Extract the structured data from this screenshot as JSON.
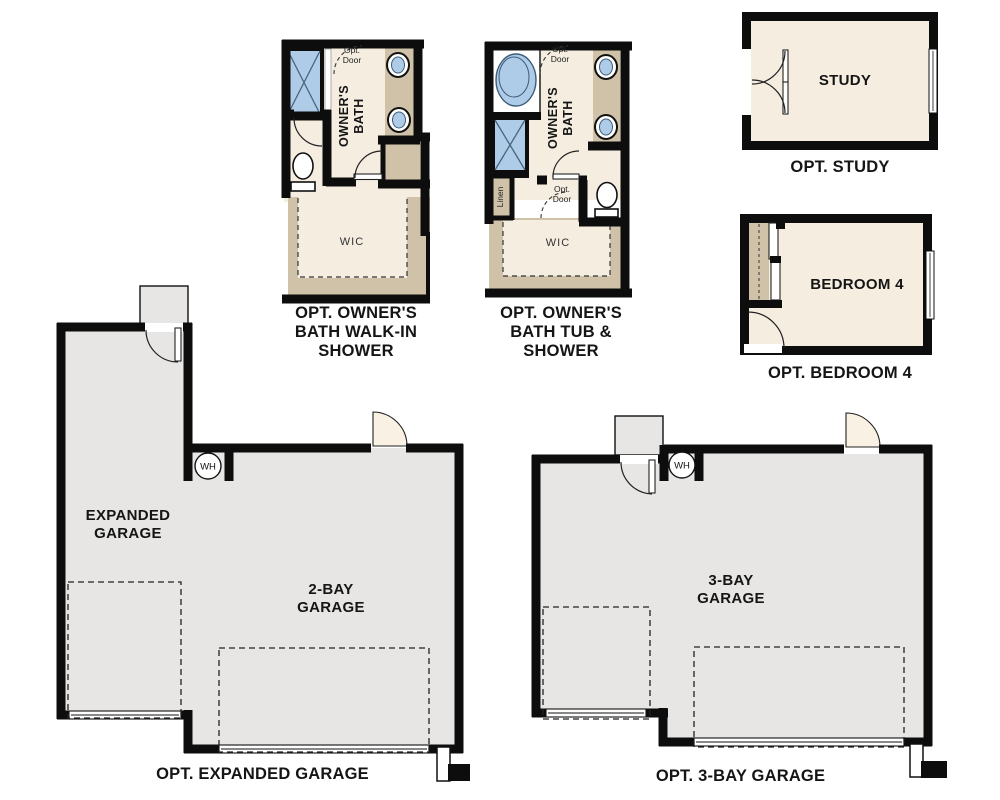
{
  "colors": {
    "wall": "#0d0d0d",
    "floor_cream": "#f5eee0",
    "floor_gray": "#e7e6e4",
    "counter_tan": "#cfc2a8",
    "fixture_blue": "#aecbe8",
    "fixture_blue_line": "#3d5c77",
    "door_cream": "#f9f1e4"
  },
  "plans": {
    "bath_walkin": {
      "caption": "OPT. OWNER'S BATH WALK-IN SHOWER",
      "room_label": "OWNER'S BATH",
      "closet_label": "WIC",
      "opt_door": "Opt. Door"
    },
    "bath_tub": {
      "caption": "OPT. OWNER'S BATH TUB & SHOWER",
      "room_label": "OWNER'S BATH",
      "closet_label": "WIC",
      "opt_door_top": "Opt. Door",
      "opt_door_mid": "Opt. Door",
      "linen_label": "Linen"
    },
    "study": {
      "caption": "OPT. STUDY",
      "room_label": "STUDY"
    },
    "bedroom4": {
      "caption": "OPT. BEDROOM 4",
      "room_label": "BEDROOM 4"
    },
    "expanded_garage": {
      "caption": "OPT. EXPANDED GARAGE",
      "left_label": "EXPANDED GARAGE",
      "right_label": "2-BAY GARAGE",
      "water_heater": "WH"
    },
    "three_bay_garage": {
      "caption": "OPT. 3-BAY GARAGE",
      "label": "3-BAY GARAGE",
      "water_heater": "WH"
    }
  }
}
